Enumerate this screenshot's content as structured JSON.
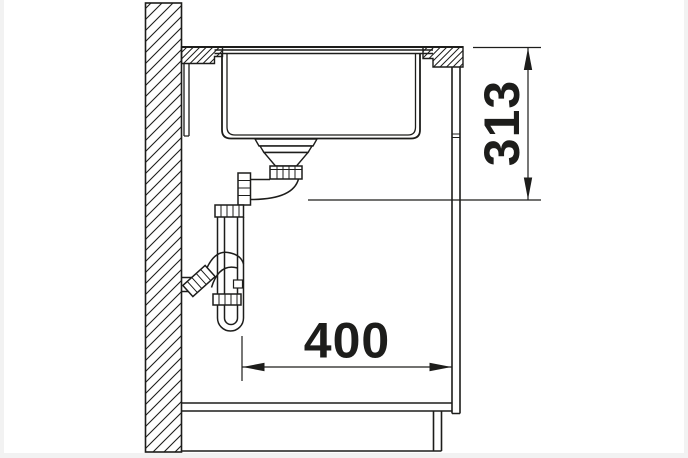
{
  "drawing": {
    "background": "#ffffff",
    "frame_color": "#f2f2f2",
    "line_color": "#1d1d1b",
    "dim_vertical": {
      "label": "313",
      "orientation": "vertical",
      "from": "countertop-top-surface",
      "to": "required-clearance-line"
    },
    "dim_horizontal": {
      "label": "400",
      "orientation": "horizontal",
      "from": "trap-outlet-pipe",
      "to": "cabinet-front-panel"
    },
    "parts": [
      "wall-section",
      "countertop-section",
      "undermount-sink-bowl",
      "basket-strainer",
      "drain-elbow",
      "space-saver-trap",
      "wall-drain-connection",
      "cabinet-front-panel",
      "cabinet-bottom-shelf",
      "plinth",
      "floor-line"
    ]
  }
}
